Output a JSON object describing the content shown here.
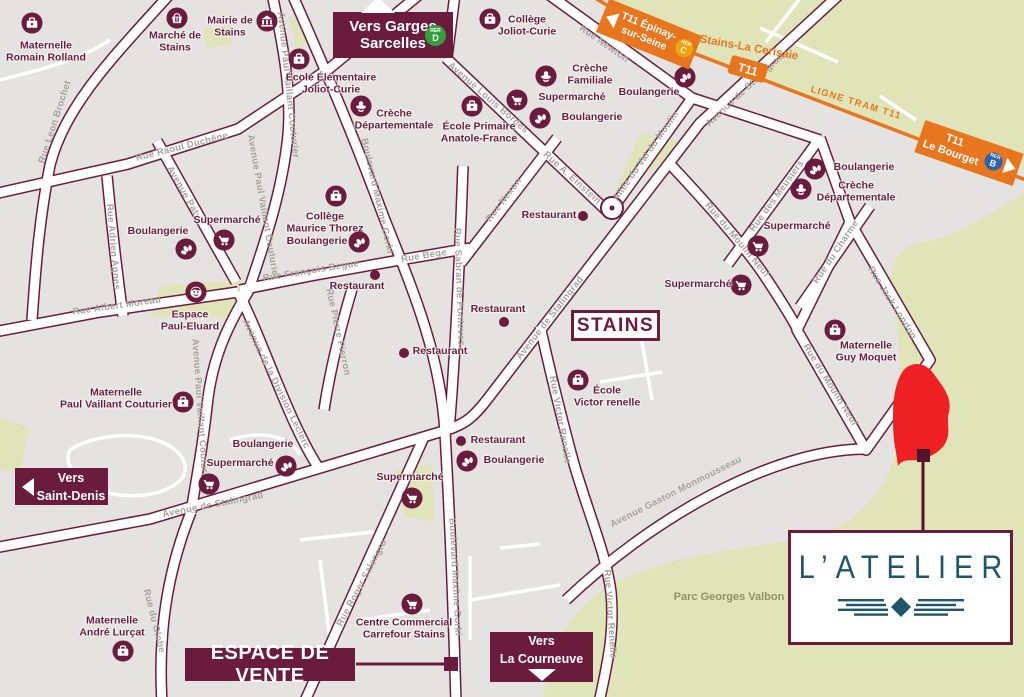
{
  "colors": {
    "maroon": "#6b1c3d",
    "land": "#e4e3e1",
    "green": "#dfe5b8",
    "orange": "#e8761e",
    "rer_d": "#33a13a",
    "rer_c": "#f2a20d",
    "rer_b": "#2a63ad",
    "red_site": "#ed2024",
    "marker_dark": "#4f152b",
    "teal": "#20566a",
    "street_text": "#a7a29d",
    "park_text": "#8d9464"
  },
  "city_box": "STAINS",
  "park_label": "Parc Georges Valbon",
  "logo": {
    "name": "L’ATELIER"
  },
  "banners": {
    "garges": {
      "line1": "Vers Garges",
      "line2": "Sarcelles",
      "rer": {
        "word": "RER",
        "letter": "D"
      }
    },
    "saint_denis": {
      "line1": "Vers",
      "line2": "Saint-Denis"
    },
    "courneuve": {
      "line1": "Vers",
      "line2": "La Courneuve"
    },
    "espace_de_vente": "ESPACE DE VENTE"
  },
  "tram": {
    "epinay": {
      "line1": "T11 Épinay-",
      "line2": "sur-Seine",
      "rer": {
        "word": "RER",
        "letter": "C"
      }
    },
    "cerisaie": "Stains-La Cerisaie",
    "station": "T11",
    "ligne": "LIGNE TRAM T11",
    "bourget": {
      "line1": "T11",
      "line2": "Le Bourget",
      "rer": {
        "word": "RER",
        "letter": "B"
      }
    }
  },
  "streets": [
    {
      "name": "Rue Leon Brochet",
      "x": 55,
      "y": 122,
      "rot": -72
    },
    {
      "name": "Rue Raoul Duchêne",
      "x": 182,
      "y": 147,
      "rot": -14
    },
    {
      "name": "Avenue Paty",
      "x": 184,
      "y": 193,
      "rot": 60
    },
    {
      "name": "Avenue Paul Vaillant Couturier",
      "x": 288,
      "y": 85,
      "rot": 84
    },
    {
      "name": "Avenue Paul Vaillant Couturier",
      "x": 263,
      "y": 207,
      "rot": 80
    },
    {
      "name": "Avenue Paul Vaillant Couturier",
      "x": 200,
      "y": 412,
      "rot": 86
    },
    {
      "name": "Rue Adrien Agnes",
      "x": 113,
      "y": 247,
      "rot": 85
    },
    {
      "name": "Rue Albert Moreau",
      "x": 117,
      "y": 306,
      "rot": -8
    },
    {
      "name": "Rue François Begue",
      "x": 311,
      "y": 271,
      "rot": -9
    },
    {
      "name": "Rue Pierre Pierron",
      "x": 338,
      "y": 332,
      "rot": 78
    },
    {
      "name": "Boulevard Maxime Gorki",
      "x": 377,
      "y": 196,
      "rot": 77
    },
    {
      "name": "Boulevard Maxime Gorki",
      "x": 455,
      "y": 577,
      "rot": 87
    },
    {
      "name": "Rue Bege",
      "x": 424,
      "y": 256,
      "rot": -9
    },
    {
      "name": "Rue Sabran de Ponteves",
      "x": 459,
      "y": 287,
      "rot": 88
    },
    {
      "name": "Rue Nexon",
      "x": 504,
      "y": 200,
      "rot": -53
    },
    {
      "name": "Avenue de Stalingrad",
      "x": 550,
      "y": 318,
      "rot": -52
    },
    {
      "name": "Avenue de Stalingrad",
      "x": 745,
      "y": 90,
      "rot": -43
    },
    {
      "name": "Avenue de Stalingrad",
      "x": 213,
      "y": 505,
      "rot": -11
    },
    {
      "name": "Rue Newton",
      "x": 604,
      "y": 44,
      "rot": 35
    },
    {
      "name": "Rue A. Einstein",
      "x": 572,
      "y": 178,
      "rot": 42
    },
    {
      "name": "Allée du Val du Moulin",
      "x": 646,
      "y": 156,
      "rot": -55
    },
    {
      "name": "Rue du Moulin Neuf",
      "x": 737,
      "y": 240,
      "rot": 50
    },
    {
      "name": "Rue du Moulin Neuf",
      "x": 830,
      "y": 385,
      "rot": 58
    },
    {
      "name": "Rue des Meusiers",
      "x": 777,
      "y": 196,
      "rot": -54
    },
    {
      "name": "Rue du Charme",
      "x": 836,
      "y": 252,
      "rot": -56
    },
    {
      "name": "Rue Jack London",
      "x": 892,
      "y": 303,
      "rot": 58
    },
    {
      "name": "Rue Victor Renelle",
      "x": 560,
      "y": 420,
      "rot": 80
    },
    {
      "name": "Rue Victor Renelle",
      "x": 610,
      "y": 614,
      "rot": 86
    },
    {
      "name": "Avenue Gaston Monmousseau",
      "x": 676,
      "y": 492,
      "rot": -27
    },
    {
      "name": "Rue Roger Salengro",
      "x": 362,
      "y": 583,
      "rot": -62
    },
    {
      "name": "Rue du Globe",
      "x": 154,
      "y": 621,
      "rot": 76
    },
    {
      "name": "Avenue de la Division Leclerc",
      "x": 276,
      "y": 384,
      "rot": 64
    },
    {
      "name": "Avenue Louis Bordes",
      "x": 488,
      "y": 98,
      "rot": 41
    }
  ],
  "landmarks": [
    {
      "type": "school",
      "lines": [
        "Maternelle",
        "Romain Rolland"
      ],
      "ix": 32,
      "iy": 23,
      "tx": 46,
      "ty": 52
    },
    {
      "type": "basket",
      "lines": [
        "Marché de",
        "Stains"
      ],
      "ix": 177,
      "iy": 18,
      "tx": 175,
      "ty": 42
    },
    {
      "type": "townhall",
      "lines": [
        "Mairie de",
        "Stains"
      ],
      "ix": 267,
      "iy": 21,
      "tx": 230,
      "ty": 27
    },
    {
      "type": "school",
      "lines": [
        "École Élémentaire",
        "Joliot-Curie"
      ],
      "ix": 299,
      "iy": 59,
      "tx": 331,
      "ty": 84
    },
    {
      "type": "school",
      "lines": [
        "Collège",
        "Joliot-Curie"
      ],
      "ix": 490,
      "iy": 19,
      "tx": 527,
      "ty": 26
    },
    {
      "type": "pacifier",
      "lines": [
        "Crèche",
        "Départementale"
      ],
      "ix": 361,
      "iy": 106,
      "tx": 394,
      "ty": 120
    },
    {
      "type": "school",
      "lines": [
        "École Primaire",
        "Anatole-France"
      ],
      "ix": 472,
      "iy": 106,
      "tx": 479,
      "ty": 133
    },
    {
      "type": "cart",
      "lines": [
        "Supermarché"
      ],
      "ix": 517,
      "iy": 100,
      "tx": 572,
      "ty": 98
    },
    {
      "type": "pretzel",
      "lines": [
        "Boulangerie"
      ],
      "ix": 540,
      "iy": 118,
      "tx": 592,
      "ty": 118
    },
    {
      "type": "pacifier",
      "lines": [
        "Crèche",
        "Familiale"
      ],
      "ix": 546,
      "iy": 76,
      "tx": 590,
      "ty": 75
    },
    {
      "type": "pretzel",
      "lines": [
        "Boulangerie"
      ],
      "ix": 685,
      "iy": 77,
      "tx": 649,
      "ty": 93
    },
    {
      "type": "cart",
      "lines": [
        "Supermarché"
      ],
      "ix": 758,
      "iy": 246,
      "tx": 797,
      "ty": 227
    },
    {
      "type": "cart",
      "lines": [
        "Supermarché"
      ],
      "ix": 741,
      "iy": 285,
      "tx": 698,
      "ty": 285
    },
    {
      "type": "pretzel",
      "lines": [
        "Boulangerie"
      ],
      "ix": 815,
      "iy": 169,
      "tx": 864,
      "ty": 168
    },
    {
      "type": "pacifier",
      "lines": [
        "Crèche",
        "Départementale"
      ],
      "ix": 801,
      "iy": 189,
      "tx": 856,
      "ty": 192
    },
    {
      "type": "school",
      "lines": [
        "Maternelle",
        "Guy Moquet"
      ],
      "ix": 835,
      "iy": 330,
      "tx": 866,
      "ty": 352
    },
    {
      "type": "school",
      "lines": [
        "École",
        "Victor renelle"
      ],
      "ix": 578,
      "iy": 380,
      "tx": 607,
      "ty": 397
    },
    {
      "type": "school",
      "lines": [
        "Maternelle",
        "Paul Vaillant Couturier"
      ],
      "ix": 183,
      "iy": 402,
      "tx": 116,
      "ty": 399
    },
    {
      "type": "school",
      "lines": [
        "Maternelle",
        "André Lurçat"
      ],
      "ix": 123,
      "iy": 651,
      "tx": 112,
      "ty": 627
    },
    {
      "type": "cart",
      "lines": [
        "Centre Commercial",
        "Carrefour Stains"
      ],
      "ix": 412,
      "iy": 604,
      "tx": 404,
      "ty": 629
    },
    {
      "type": "face",
      "lines": [
        "Espace",
        "Paul-Eluard"
      ],
      "ix": 196,
      "iy": 292,
      "tx": 190,
      "ty": 321
    },
    {
      "type": "school",
      "lines": [
        "Collège",
        "Maurice Thorez"
      ],
      "ix": 336,
      "iy": 196,
      "tx": 325,
      "ty": 223
    },
    {
      "type": "pretzel",
      "lines": [
        "Boulangerie"
      ],
      "ix": 359,
      "iy": 242,
      "tx": 317,
      "ty": 242
    },
    {
      "type": "cart",
      "lines": [
        "Supermarché"
      ],
      "ix": 224,
      "iy": 240,
      "tx": 227,
      "ty": 221
    },
    {
      "type": "pretzel",
      "lines": [
        "Boulangerie"
      ],
      "ix": 186,
      "iy": 249,
      "tx": 158,
      "ty": 232
    },
    {
      "type": "cart",
      "lines": [
        "Supermarché"
      ],
      "ix": 209,
      "iy": 484,
      "tx": 240,
      "ty": 464
    },
    {
      "type": "pretzel",
      "lines": [
        "Boulangerie"
      ],
      "ix": 286,
      "iy": 466,
      "tx": 263,
      "ty": 445
    },
    {
      "type": "cart",
      "lines": [
        "Supermarché"
      ],
      "ix": 412,
      "iy": 498,
      "tx": 410,
      "ty": 478
    },
    {
      "type": "pretzel",
      "lines": [
        "Boulangerie"
      ],
      "ix": 467,
      "iy": 461,
      "tx": 514,
      "ty": 461
    },
    {
      "type": "dot",
      "lines": [
        "Restaurant"
      ],
      "ix": 461,
      "iy": 441,
      "tx": 498,
      "ty": 441
    },
    {
      "type": "dot",
      "lines": [
        "Restaurant"
      ],
      "ix": 583,
      "iy": 216,
      "tx": 549,
      "ty": 216
    },
    {
      "type": "dot",
      "lines": [
        "Restaurant"
      ],
      "ix": 504,
      "iy": 322,
      "tx": 498,
      "ty": 310
    },
    {
      "type": "dot",
      "lines": [
        "Restaurant"
      ],
      "ix": 404,
      "iy": 353,
      "tx": 440,
      "ty": 352
    },
    {
      "type": "dot",
      "lines": [
        "Restaurant"
      ],
      "ix": 375,
      "iy": 275,
      "tx": 357,
      "ty": 287
    }
  ]
}
